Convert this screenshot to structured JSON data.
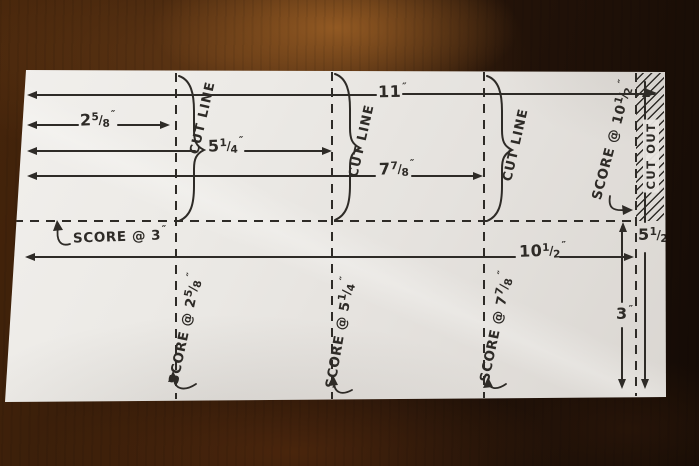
{
  "colors": {
    "ink": "#2e2b27",
    "paper": "#e9e6e2",
    "wood": "#46250b"
  },
  "labels": {
    "cut_line": "CUT LINE",
    "cut_out": "CUT OUT",
    "slash": "/"
  },
  "dimensions": {
    "total_width": {
      "whole": "11",
      "unit": "″"
    },
    "cut1": {
      "whole": "2",
      "num": "5",
      "den": "8",
      "unit": "″"
    },
    "cut2": {
      "whole": "5",
      "num": "1",
      "den": "4",
      "unit": "″"
    },
    "cut3": {
      "whole": "7",
      "num": "7",
      "den": "8",
      "unit": "″"
    },
    "score_right": {
      "whole": "10",
      "num": "1",
      "den": "2",
      "unit": "″"
    },
    "height_score": {
      "whole": "3",
      "unit": "″"
    },
    "total_height": {
      "whole": "5",
      "num": "1",
      "den": "2",
      "unit": "″"
    }
  },
  "scores": {
    "left": {
      "prefix": "SCORE @",
      "whole": "3",
      "unit": "″"
    },
    "s1": {
      "prefix": "SCORE @",
      "whole": "2",
      "num": "5",
      "den": "8",
      "unit": "″"
    },
    "s2": {
      "prefix": "SCORE @",
      "whole": "5",
      "num": "1",
      "den": "4",
      "unit": "″"
    },
    "s3": {
      "prefix": "SCORE @",
      "whole": "7",
      "num": "7",
      "den": "8",
      "unit": "″"
    },
    "s4": {
      "prefix": "SCORE @",
      "whole": "10",
      "num": "1",
      "den": "2",
      "unit": "″"
    }
  }
}
